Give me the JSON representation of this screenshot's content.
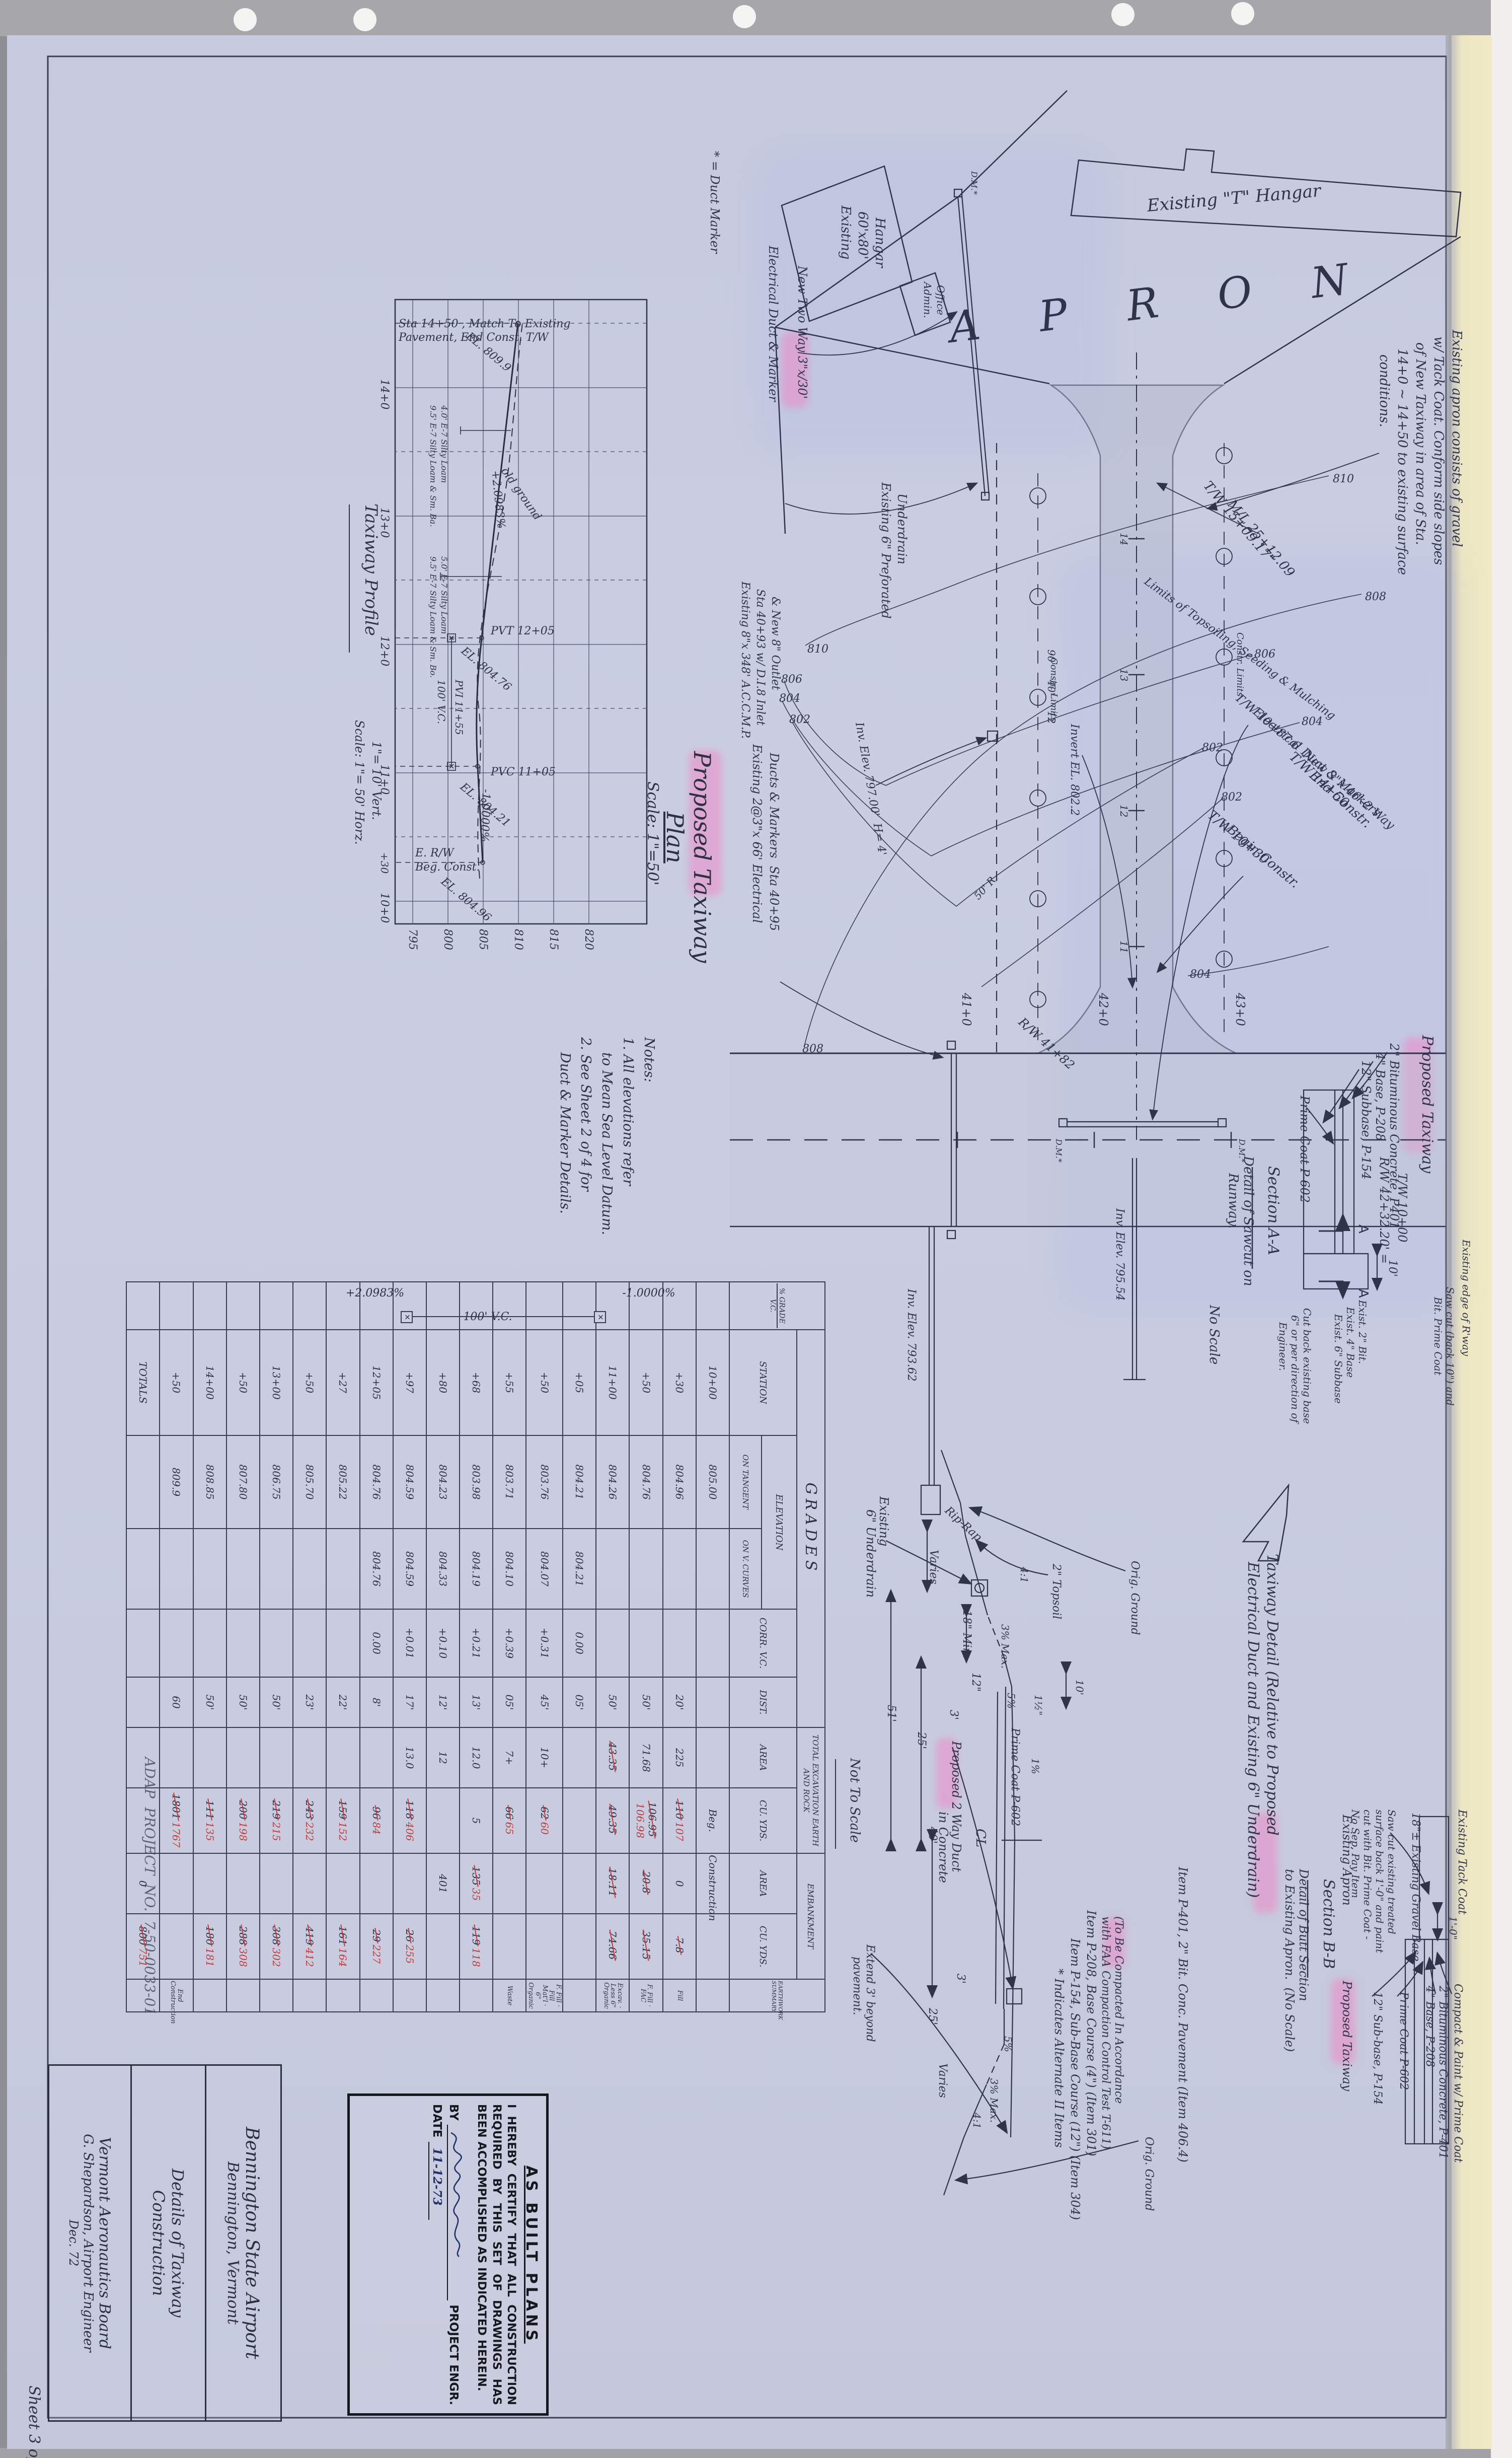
{
  "sheet": {
    "number": "Sheet 3 of 4",
    "project": "ADAP  PROJECT  NO.  7-50-0033-01"
  },
  "title_block": {
    "airport_l1": "Bennington State Airport",
    "airport_l2": "Bennington, Vermont",
    "title_l1": "Details of Taxiway",
    "title_l2": "Construction",
    "agency_l1": "Vermont Aeronautics Board",
    "agency_l2": "G. Shepardson, Airport Engineer",
    "agency_l3": "Dec. 72"
  },
  "stamp": {
    "heading": "AS BUILT PLANS",
    "body": "I HEREBY CERTIFY THAT ALL CONSTRUCTION REQUIRED BY THIS SET OF DRAWINGS HAS BEEN ACCOMPLISHED AS INDICATED HEREIN.",
    "by_label": "BY",
    "by_suffix": "PROJECT ENGR.",
    "date_label": "DATE",
    "date_value": "11-12-73"
  },
  "notes": {
    "l1": "Notes:",
    "l2": "1. All elevations refer",
    "l3": "to Mean Sea Level Datum.",
    "l4": "2. See Sheet 2 of 4 for",
    "l5": "Duct & Marker Details."
  },
  "plan": {
    "title_l1": "Proposed Taxiway",
    "title_l2": "Plan",
    "scale": "Scale: 1\"=50'",
    "duct_marker_key": "* = Duct Marker",
    "hangar60_l1": "Existing",
    "hangar60_l2": "60'x80'",
    "hangar60_l3": "Hangar",
    "admin_l1": "Admin.",
    "admin_l2": "Office",
    "t_hangar": "Existing \"T\" Hangar",
    "apron": "A P R O N",
    "new_two_way": "New Two Way 3\"x/30'",
    "elec_duct": "Electrical Duct & Marker",
    "tw1509": "T/W 15+09.17\"",
    "ml2512": "M/L 25+12.09",
    "tw1450_l1": "T/W 14+50",
    "tw1450_l2": "End Constr.",
    "invert8022": "Invert EL. 802.2",
    "apron_note_l1": "Existing apron consists of gravel",
    "apron_note_l2": "w/ Tack Coat. Conform side slopes",
    "apron_note_l3": "of New Taxiway in area of Sta.",
    "apron_note_l4": "14+0 ~ 14+50 to existing surface",
    "apron_note_l5": "conditions.",
    "underdrain6_l1": "Existing 6\" Preforated",
    "underdrain6_l2": "Underdrain",
    "accmp_l1": "Existing 8\"x 348' A.C.C.M.P.",
    "accmp_l2": "Sta 40+93 w/ D.I.8 Inlet",
    "accmp_l3": "& New 8\" Outlet",
    "ducts_l1": "Existing 2@3\"x 66' Electrical",
    "ducts_l2": "Ducts & Markers  Sta 40+95",
    "inv797": "Inv. Elev. 797.00'  H= 4'",
    "limits": "Limits of Topsoiling, Seeding & Mulching",
    "tw1087_l1": "T/W 10+87.6  New 3\"x 46'-2 Way",
    "tw1087_l2": "Electrical Duct & Markers",
    "tw1030_l1": "T/W 10+30",
    "tw1030_l2": "Begin Constr.",
    "rw4182": "R/W 41+82",
    "rw4232_l1": "R/W 42+32.20' =",
    "rw4232_l2": "T/W 10+00",
    "inv79554": "Inv. Elev. 795.54",
    "inv79362": "Inv. Elev. 793.62",
    "riprap": "Rip-Rap",
    "const_limits": "Constr. Limits",
    "sta41": "41+0",
    "sta42": "42+0",
    "sta43": "43+0",
    "t11": "11",
    "t12": "12",
    "t13": "13",
    "t14": "14",
    "dm": "D.M.*",
    "c810": "810",
    "c808": "808",
    "c806": "806",
    "c804": "804",
    "c802": "802",
    "dim90": "90'",
    "dim40": "40'",
    "dim12": "12",
    "r50": "50' R.",
    "secA": "A"
  },
  "profile": {
    "title": "Taxiway Profile",
    "scale_l1": "Scale: 1\"= 50' Horz.",
    "scale_l2": "1\"= 10' Vert.",
    "match_l1": "Sta 14+50 , Match To Existing",
    "match_l2": "Pavement, End Const. T/W",
    "el8099": "EL. 809.9",
    "old_ground": "old ground",
    "gplus": "+2.0983%",
    "gminus": "-1.0000%",
    "pvt": "PVT 12+05",
    "el80476": "EL. 804.76",
    "pvi": "PVI 11+55",
    "vc": "100' V.C.",
    "pvc": "PVC 11+05",
    "el80421": "EL. 804.21",
    "erw": "E. R/W",
    "beg": "Beg. Const.",
    "el80496": "EL. 804.96",
    "b1": "5.0' E-7 Silty Loam",
    "b2": "9.5' E-7 Silty Loam & Sm. Bo.",
    "b3": "4.0' E-7 Silty Loam",
    "b4": "9.5' E-7 Silty Loam & Sm. Ba.",
    "s14": "14+0",
    "s13": "13+0",
    "s12": "12+0",
    "s11": "11+0",
    "s1030": "+30",
    "s10": "10+0",
    "e820": "820",
    "e815": "815",
    "e810": "810",
    "e805": "805",
    "e800": "800",
    "e795": "795"
  },
  "grades_table": {
    "title": "GRADES",
    "col_grade": "% GRADE",
    "col_vc": "V.C.",
    "col_station": "STATION",
    "col_elev": "ELEVATION",
    "col_on_tan": "ON TANGENT",
    "col_on_vc": "ON V. CURVES",
    "col_corr": "CORR. V.C.",
    "col_dist": "DIST.",
    "grp_exc": "TOTAL EXCAVATION EARTH AND ROCK",
    "col_area": "AREA",
    "col_cuyds": "CU. YDS.",
    "grp_emb": "EMBANKMENT",
    "grp_sum": "EARTHWORK SUMMARY",
    "grade_minus": "-1.0000%",
    "grade_plus": "+2.0983%",
    "vc_label": "100' V.C.",
    "rows": [
      {
        "station": "10+00",
        "elev_t": "805.00",
        "exc_cu": "Beg.",
        "emb_area": "Construction"
      },
      {
        "station": "+30",
        "elev_t": "804.96",
        "dist": "20'",
        "exc_area": "225",
        "exc_cu_old": "110",
        "exc_cu": "107",
        "emb_area": "0",
        "emb_cu_old": "7.8",
        "summary": "Fill"
      },
      {
        "station": "+50",
        "elev_t": "804.76",
        "dist": "50'",
        "exc_area": "71.68",
        "exc_cu_old": "106.95",
        "exc_cu": "106.98",
        "emb_area_old": "20.8",
        "emb_cu_old": "35.15",
        "summary": "F. Fill · FAC"
      },
      {
        "station": "11+00",
        "elev_t": "804.26",
        "dist": "50'",
        "exc_area_old": "43.35",
        "exc_cu_old": "49.35",
        "emb_area_old": "18.11",
        "emb_cu_old": "74.66",
        "summary": "Excav. · Less 6\" Organic"
      },
      {
        "station": "+05",
        "elev_t": "804.21",
        "elev_vc": "804.21",
        "corr": "0.00",
        "dist": "05'"
      },
      {
        "station": "+50",
        "elev_t": "803.76",
        "elev_vc": "804.07",
        "corr": "+0.31",
        "dist": "45'",
        "exc_area": "10+",
        "exc_cu_old": "62",
        "exc_cu": "60",
        "summary": "F. Fill · Fill Mat'l · 6\" Organic"
      },
      {
        "station": "+55",
        "elev_t": "803.71",
        "elev_vc": "804.10",
        "corr": "+0.39",
        "dist": "05'",
        "exc_area": "7+",
        "exc_cu_old": "66",
        "exc_cu": "65",
        "summary": "Waste"
      },
      {
        "station": "+68",
        "elev_t": "803.98",
        "elev_vc": "804.19",
        "corr": "+0.21",
        "dist": "13'",
        "exc_area": "12.0",
        "exc_cu": "5",
        "emb_area_old": "135",
        "emb_area": "35",
        "emb_cu_old": "119",
        "emb_cu": "118"
      },
      {
        "station": "+80",
        "elev_t": "804.23",
        "elev_vc": "804.33",
        "corr": "+0.10",
        "dist": "12'",
        "exc_area": "12",
        "emb_area": "401"
      },
      {
        "station": "+97",
        "elev_t": "804.59",
        "elev_vc": "804.59",
        "corr": "+0.01",
        "dist": "17'",
        "exc_area": "13.0",
        "exc_cu_old": "118",
        "exc_cu": "406",
        "emb_cu_old": "26",
        "emb_cu": "255"
      },
      {
        "station": "12+05",
        "elev_t": "804.76",
        "elev_vc": "804.76",
        "corr": "0.00",
        "dist": "8'",
        "exc_cu_old": "96",
        "exc_cu": "84",
        "emb_cu_old": "29",
        "emb_cu": "227"
      },
      {
        "station": "+27",
        "elev_t": "805.22",
        "dist": "22'",
        "exc_cu_old": "159",
        "exc_cu": "152",
        "emb_cu_old": "161",
        "emb_cu": "164"
      },
      {
        "station": "+50",
        "elev_t": "805.70",
        "dist": "23'",
        "exc_cu_old": "243",
        "exc_cu": "232",
        "emb_cu_old": "419",
        "emb_cu": "412"
      },
      {
        "station": "13+00",
        "elev_t": "806.75",
        "dist": "50'",
        "exc_cu_old": "219",
        "exc_cu": "215",
        "emb_cu_old": "308",
        "emb_cu": "302"
      },
      {
        "station": "+50",
        "elev_t": "807.80",
        "dist": "50'",
        "exc_cu_old": "200",
        "exc_cu": "198",
        "emb_cu_old": "288",
        "emb_cu": "308"
      },
      {
        "station": "14+00",
        "elev_t": "808.85",
        "dist": "50'",
        "exc_cu_old": "111",
        "exc_cu": "135",
        "emb_cu_old": "180",
        "emb_cu": "181"
      },
      {
        "station": "+50",
        "elev_t": "809.9",
        "dist": "60",
        "exc_cu_old": "1801",
        "exc_cu": "1767",
        "summary": "End Construction"
      },
      {
        "station": "TOTALS",
        "emb_area": "0",
        "emb_cu_old": "800",
        "emb_cu": "751"
      }
    ]
  },
  "section_aa": {
    "heading": "Proposed Taxiway",
    "l_bit": "2\" Bituminous Concrete, P401",
    "l_base": "4\" Base, P-208",
    "l_sub": "12\" Subbase, P-154",
    "l_prime": "Prime Coat P-602",
    "dim10": "10'",
    "l_exist_edge": "Existing edge of R'way",
    "l_saw_l1": "Saw cut (back 10\") and",
    "l_saw_l2": "Bit. Prime Coat",
    "l_ex_l1": "Exist. 2\" Bit.",
    "l_ex_l2": "Exist. 4\" Base",
    "l_ex_l3": "Exist. 6\" Subbase",
    "l_cut_l1": "Cut back existing base",
    "l_cut_l2": "6\" or per direction of",
    "l_cut_l3": "Engineer.",
    "title": "Section A-A",
    "sub_l1": "Detail of Sawcut on",
    "sub_l2": "Runway.",
    "noscale": "No Scale"
  },
  "detail": {
    "title_l1": "Taxiway Detail (Relative to Proposed",
    "title_l2": "Electrical Duct and Existing 6\" Underdrain)",
    "notscale": "Not To Scale",
    "ud_l1": "Existing",
    "ud_l2": "6\" Underdrain",
    "varies1": "Varies",
    "d25a": "25'",
    "d51": "51'",
    "d18min": "18\" Min.",
    "d12": "12\"",
    "d3a": "3'",
    "topsoil": "2\" Topsoil",
    "orig1": "Orig. Ground",
    "slope41a": "4:1",
    "max3a": "3% Max.",
    "p5a": "5%",
    "d112": "1½\"",
    "d10": "10'",
    "prime": "Prime Coat P-602",
    "p1": "1%",
    "cl": "CL",
    "duct_l1": "Proposed 2 Way Duct",
    "duct_l2": "in Concrete",
    "d3b": "3'",
    "d25b": "25'",
    "d40": "40'",
    "varies2": "Varies",
    "extend_l1": "Extend 3' beyond",
    "extend_l2": "pavement.",
    "orig2": "Orig. Ground",
    "p5b": "5%",
    "max3b": "3% Max.",
    "slope41b": "4:1",
    "item401": "Item P-401, 2\" Bit. Conc. Pavement (Item 406.4)",
    "tobe_l1": "(To Be Compacted In Accordance",
    "tobe_l2": "with FAA Compaction Control Test T-611)",
    "item208": "Item P-208, Base Course (4\") (Item 301)",
    "item154": "Item P-154, Sub-Base Course (12\") (Item 304)",
    "alt": "* Indicates Alternate II Items"
  },
  "section_bb": {
    "tack": "Existing Tack Coat",
    "gravel": "18\"± Existing Gravel Base",
    "dim10": "1'-0\"",
    "saw_l1": "Saw cut existing treated",
    "saw_l2": "surface back 1'-0\" and paint",
    "saw_l3": "cut with Bit. Prime Coat -",
    "saw_l4": "No Sep. Pay Item",
    "compact": "Compact & Paint w/ Prime Coat",
    "bit": "2\" Bituminous Concrete, P-401",
    "base": "4\" Base, P-208",
    "prime": "Prime Coat P-602",
    "sub": "12\" Sub-base, P-154",
    "existing_apron": "Existing Apron",
    "proposed_taxiway": "Proposed Taxiway",
    "title": "Section B-B",
    "sub_l1": "Detail of Butt Section",
    "sub_l2": "to Existing Apron.  (No Scale)"
  }
}
